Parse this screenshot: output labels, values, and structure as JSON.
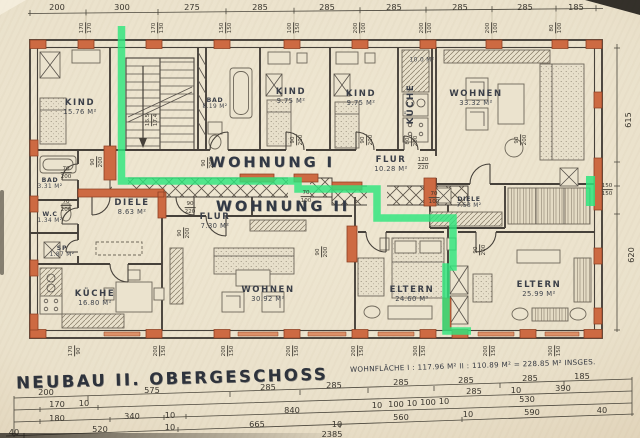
{
  "meta": {
    "title": "NEUBAU  II. OBERGESCHOSS",
    "area_note": "WOHNFLÄCHE   I : 117.96 M²   II : 110.89 M²  =   228.85 M²  INSGES.",
    "total_length": "2385"
  },
  "colors": {
    "paper": "#eae2cd",
    "ink": "#46413a",
    "wall_orange": "#cd6a42",
    "wall_dark": "#8d3f22",
    "route_green": "#2ee57d"
  },
  "apartments": [
    {
      "label": "WOHNUNG I",
      "x": 272,
      "y": 163
    },
    {
      "label": "WOHNUNG II",
      "x": 283,
      "y": 207
    }
  ],
  "rooms": [
    {
      "name": "KIND",
      "area": "15.76 M²",
      "x": 80,
      "y": 108
    },
    {
      "name": "BAD",
      "area": "8.19 M²",
      "x": 215,
      "y": 104,
      "small": true
    },
    {
      "name": "KIND",
      "area": "9.75 M²",
      "x": 291,
      "y": 97
    },
    {
      "name": "KIND",
      "area": "9.75 M²",
      "x": 361,
      "y": 99
    },
    {
      "name": "KÜCHE",
      "area": "",
      "x": 412,
      "y": 104,
      "vert": true
    },
    {
      "name": "",
      "area": "10.0 M²",
      "x": 422,
      "y": 61,
      "small": true
    },
    {
      "name": "WOHNEN",
      "area": "33.32 M²",
      "x": 476,
      "y": 99
    },
    {
      "name": "FLUR",
      "area": "10.28 M²",
      "x": 391,
      "y": 165
    },
    {
      "name": "DIELE",
      "area": "8.63 M²",
      "x": 132,
      "y": 208
    },
    {
      "name": "FLUR",
      "area": "7.30 M²",
      "x": 215,
      "y": 222
    },
    {
      "name": "DIELE",
      "area": "7.58 M²",
      "x": 469,
      "y": 203,
      "small": true
    },
    {
      "name": "BAD",
      "area": "3.31 M²",
      "x": 50,
      "y": 184,
      "small": true
    },
    {
      "name": "W.C",
      "area": "1.34 M²",
      "x": 50,
      "y": 218,
      "small": true
    },
    {
      "name": "SP",
      "area": "1.87 M²",
      "x": 62,
      "y": 252,
      "small": true
    },
    {
      "name": "KÜCHE",
      "area": "16.80 M²",
      "x": 95,
      "y": 299
    },
    {
      "name": "WOHNEN",
      "area": "30.92 M²",
      "x": 268,
      "y": 295
    },
    {
      "name": "ELTERN",
      "area": "24.60 M²",
      "x": 412,
      "y": 295
    },
    {
      "name": "ELTERN",
      "area": "25.99 M²",
      "x": 539,
      "y": 290
    }
  ],
  "dims": [
    {
      "t": "200",
      "x": 57,
      "y": 7
    },
    {
      "t": "300",
      "x": 122,
      "y": 7
    },
    {
      "t": "275",
      "x": 192,
      "y": 7
    },
    {
      "t": "285",
      "x": 260,
      "y": 7
    },
    {
      "t": "285",
      "x": 327,
      "y": 7
    },
    {
      "t": "285",
      "x": 394,
      "y": 7
    },
    {
      "t": "285",
      "x": 460,
      "y": 7
    },
    {
      "t": "285",
      "x": 525,
      "y": 7
    },
    {
      "t": "185",
      "x": 576,
      "y": 7
    },
    {
      "t": "615",
      "x": 628,
      "y": 120,
      "r": 1
    },
    {
      "t": "620",
      "x": 631,
      "y": 255,
      "r": 1
    },
    {
      "t": "200",
      "x": 46,
      "y": 392
    },
    {
      "t": "575",
      "x": 152,
      "y": 390
    },
    {
      "t": "285",
      "x": 268,
      "y": 387
    },
    {
      "t": "285",
      "x": 334,
      "y": 385
    },
    {
      "t": "285",
      "x": 401,
      "y": 382
    },
    {
      "t": "285",
      "x": 466,
      "y": 380
    },
    {
      "t": "285",
      "x": 530,
      "y": 378
    },
    {
      "t": "185",
      "x": 582,
      "y": 376
    },
    {
      "t": "170",
      "x": 57,
      "y": 404
    },
    {
      "t": "10",
      "x": 84,
      "y": 403
    },
    {
      "t": "285",
      "x": 474,
      "y": 391
    },
    {
      "t": "10",
      "x": 516,
      "y": 390
    },
    {
      "t": "390",
      "x": 563,
      "y": 388
    },
    {
      "t": "180",
      "x": 57,
      "y": 418
    },
    {
      "t": "340",
      "x": 132,
      "y": 416
    },
    {
      "t": "10",
      "x": 170,
      "y": 415
    },
    {
      "t": "840",
      "x": 292,
      "y": 410
    },
    {
      "t": "10",
      "x": 377,
      "y": 405
    },
    {
      "t": "100",
      "x": 396,
      "y": 404
    },
    {
      "t": "10",
      "x": 412,
      "y": 403
    },
    {
      "t": "100",
      "x": 428,
      "y": 402
    },
    {
      "t": "10",
      "x": 444,
      "y": 401
    },
    {
      "t": "530",
      "x": 527,
      "y": 399
    },
    {
      "t": "40",
      "x": 14,
      "y": 432
    },
    {
      "t": "520",
      "x": 100,
      "y": 429
    },
    {
      "t": "10",
      "x": 170,
      "y": 427
    },
    {
      "t": "665",
      "x": 257,
      "y": 424
    },
    {
      "t": "560",
      "x": 401,
      "y": 417
    },
    {
      "t": "10",
      "x": 468,
      "y": 414
    },
    {
      "t": "590",
      "x": 532,
      "y": 412
    },
    {
      "t": "40",
      "x": 602,
      "y": 410
    },
    {
      "t": "10",
      "x": 337,
      "y": 424
    },
    {
      "t": "2385",
      "x": 332,
      "y": 434
    }
  ],
  "small_dims": [
    {
      "a": "170",
      "b": "170",
      "x": 86,
      "y": 28,
      "r": 1
    },
    {
      "a": "170",
      "b": "130",
      "x": 158,
      "y": 28,
      "r": 1
    },
    {
      "a": "150",
      "b": "150",
      "x": 226,
      "y": 28,
      "r": 1
    },
    {
      "a": "100",
      "b": "150",
      "x": 294,
      "y": 28,
      "r": 1
    },
    {
      "a": "200",
      "b": "100",
      "x": 360,
      "y": 28,
      "r": 1
    },
    {
      "a": "200",
      "b": "100",
      "x": 426,
      "y": 28,
      "r": 1
    },
    {
      "a": "200",
      "b": "100",
      "x": 492,
      "y": 28,
      "r": 1
    },
    {
      "a": "80",
      "b": "100",
      "x": 556,
      "y": 28,
      "r": 1
    },
    {
      "a": "170",
      "b": "90",
      "x": 75,
      "y": 351,
      "r": 1
    },
    {
      "a": "200",
      "b": "150",
      "x": 160,
      "y": 351,
      "r": 1
    },
    {
      "a": "200",
      "b": "150",
      "x": 228,
      "y": 351,
      "r": 1
    },
    {
      "a": "200",
      "b": "150",
      "x": 293,
      "y": 351,
      "r": 1
    },
    {
      "a": "200",
      "b": "150",
      "x": 358,
      "y": 351,
      "r": 1
    },
    {
      "a": "300",
      "b": "150",
      "x": 420,
      "y": 351,
      "r": 1
    },
    {
      "a": "200",
      "b": "150",
      "x": 490,
      "y": 351,
      "r": 1
    },
    {
      "a": "300",
      "b": "150",
      "x": 555,
      "y": 351,
      "r": 1
    },
    {
      "a": "150",
      "b": "150",
      "x": 607,
      "y": 190,
      "r": 0
    },
    {
      "a": "90",
      "b": "200",
      "x": 208,
      "y": 163,
      "r": 1
    },
    {
      "a": "90",
      "b": "200",
      "x": 297,
      "y": 140,
      "r": 1
    },
    {
      "a": "90",
      "b": "200",
      "x": 367,
      "y": 140,
      "r": 1
    },
    {
      "a": "80",
      "b": "200",
      "x": 412,
      "y": 141,
      "r": 1
    },
    {
      "a": "90",
      "b": "200",
      "x": 97,
      "y": 162,
      "r": 1
    },
    {
      "a": "70",
      "b": "200",
      "x": 66,
      "y": 173,
      "r": 0
    },
    {
      "a": "70",
      "b": "200",
      "x": 66,
      "y": 206,
      "r": 0
    },
    {
      "a": "120",
      "b": "220",
      "x": 423,
      "y": 164,
      "r": 0
    },
    {
      "a": "90",
      "b": "220",
      "x": 190,
      "y": 208,
      "r": 0
    },
    {
      "a": "70",
      "b": "100",
      "x": 306,
      "y": 197,
      "r": 0
    },
    {
      "a": "70",
      "b": "100",
      "x": 434,
      "y": 198,
      "r": 0
    },
    {
      "a": "90",
      "b": "200",
      "x": 184,
      "y": 233,
      "r": 1
    },
    {
      "a": "90",
      "b": "200",
      "x": 322,
      "y": 252,
      "r": 1
    },
    {
      "a": "90",
      "b": "200",
      "x": 521,
      "y": 140,
      "r": 1
    },
    {
      "a": "16.5",
      "b": "17.4",
      "x": 152,
      "y": 120,
      "r": 1
    },
    {
      "a": "90",
      "b": "200",
      "x": 480,
      "y": 250,
      "r": 1
    }
  ],
  "route": {
    "points": "121.5,26 121.5,181 298,181 298,189 377,189 377,218 453,218 453,267 446,267 446,331 471,331",
    "marker": {
      "x": 586,
      "y": 176,
      "w": 9,
      "h": 30
    }
  }
}
